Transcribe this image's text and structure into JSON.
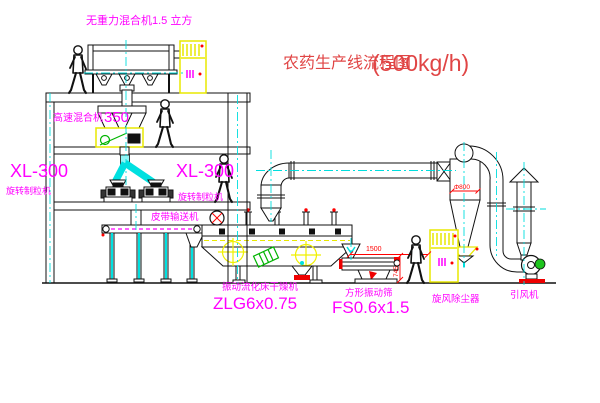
{
  "title": {
    "text": "农药生产线流程图",
    "capacity": "(500kg/h)"
  },
  "labels": {
    "gravity_mixer": "无重力混合机1.5 立方",
    "high_speed_mixer": "高速混合机",
    "high_speed_mixer_model": "350",
    "granulator_left_model": "XL-300",
    "granulator_left_name": "旋转制粒机",
    "granulator_right_model": "XL-300",
    "granulator_right_name": "旋转制粒机",
    "belt_conveyor": "皮带输送机",
    "dryer_name": "振动流化床干燥机",
    "dryer_model": "ZLG6x0.75",
    "sieve_name": "方形振动筛",
    "sieve_model": "FS0.6x1.5",
    "cyclone_name": "旋风除尘器",
    "fan_name": "引风机"
  },
  "dimensions": {
    "sieve_width": "1500",
    "sieve_height": "745",
    "cyclone_diameter": "Φ800"
  },
  "colors": {
    "label": "#ff00ff",
    "title": "#e04545",
    "dimension": "#ff0000",
    "centerline": "#00dede",
    "cabinet": "#e8e800",
    "motor": "#1ec41e",
    "line": "#111111",
    "background": "#ffffff"
  }
}
